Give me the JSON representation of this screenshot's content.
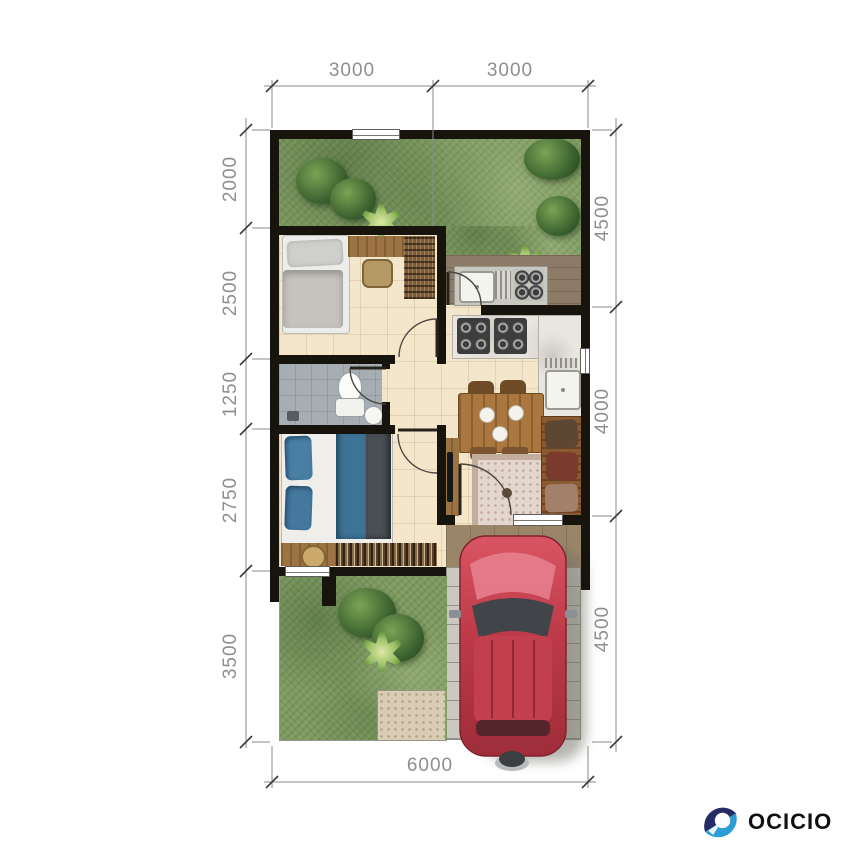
{
  "logo": {
    "text": "OCICIO",
    "icon": "ocicio-ring-icon",
    "icon_color_dark": "#252b66",
    "icon_color_light": "#2d9ed5",
    "text_color": "#101010"
  },
  "floor_plan": {
    "unit": "millimeters",
    "dimensions": {
      "top": [
        "3000",
        "3000"
      ],
      "left": [
        "2000",
        "2500",
        "1250",
        "2750",
        "3500"
      ],
      "right": [
        "4500",
        "4000",
        "4500"
      ],
      "bottom": [
        "6000"
      ]
    },
    "palette": {
      "wall": "#17130d",
      "grass": "#7e9a60",
      "interior_tile": "#f3e6cb",
      "bathroom_tile": "#a6aeb4",
      "service_floor": "#8c7b66",
      "terrace_floor": "#9b8569",
      "carport_paving": "#cbc8c0",
      "wood": "#9c7444",
      "car_body": "#c13d4c",
      "dimension_text": "#8f8f8f"
    }
  }
}
